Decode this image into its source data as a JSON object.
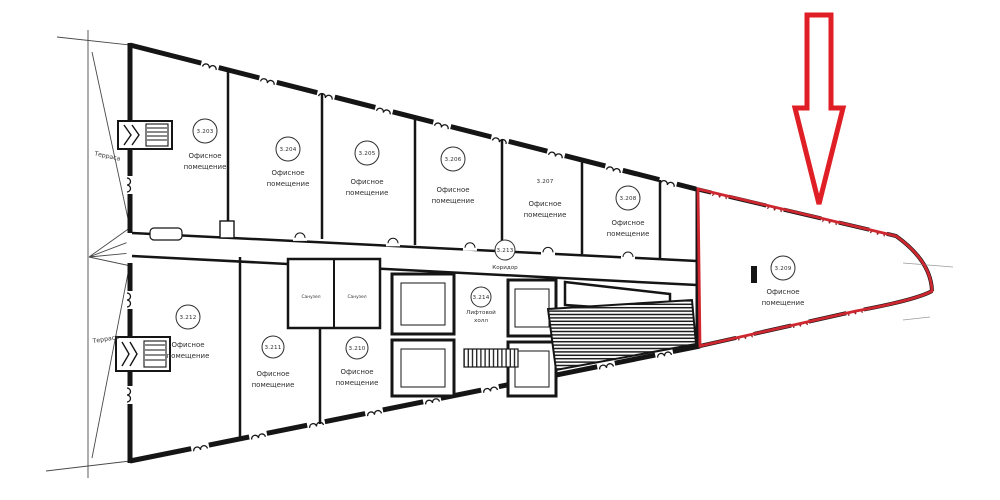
{
  "colors": {
    "wall": "#151515",
    "thin_line": "#4a4a4a",
    "highlight_red": "#cf2730",
    "arrow_red": "#e01e26"
  },
  "annotation": {
    "arrow_icon": "down-arrow",
    "highlighted_room_number": "3.209"
  },
  "terraces": [
    {
      "label": "Терраса"
    },
    {
      "label": "Терраса"
    }
  ],
  "rooms": [
    {
      "number": "3.203",
      "label_line1": "Офисное",
      "label_line2": "помещение"
    },
    {
      "number": "3.204",
      "label_line1": "Офисное",
      "label_line2": "помещение"
    },
    {
      "number": "3.205",
      "label_line1": "Офисное",
      "label_line2": "помещение"
    },
    {
      "number": "3.206",
      "label_line1": "Офисное",
      "label_line2": "помещение"
    },
    {
      "number": "3.207",
      "label_line1": "Офисное",
      "label_line2": "помещение"
    },
    {
      "number": "3.208",
      "label_line1": "Офисное",
      "label_line2": "помещение"
    },
    {
      "number": "3.209",
      "label_line1": "Офисное",
      "label_line2": "помещение",
      "highlighted": true
    },
    {
      "number": "3.210",
      "label_line1": "Офисное",
      "label_line2": "помещение"
    },
    {
      "number": "3.211",
      "label_line1": "Офисное",
      "label_line2": "помещение"
    },
    {
      "number": "3.212",
      "label_line1": "Офисное",
      "label_line2": "помещение"
    }
  ],
  "corridor": {
    "number": "3.213",
    "label": "Коридор"
  },
  "lift_hall": {
    "number": "3.214",
    "label_line1": "Лифтовой",
    "label_line2": "холл"
  },
  "sanitary": [
    {
      "label": "Санузел"
    },
    {
      "label": "Санузел"
    }
  ]
}
